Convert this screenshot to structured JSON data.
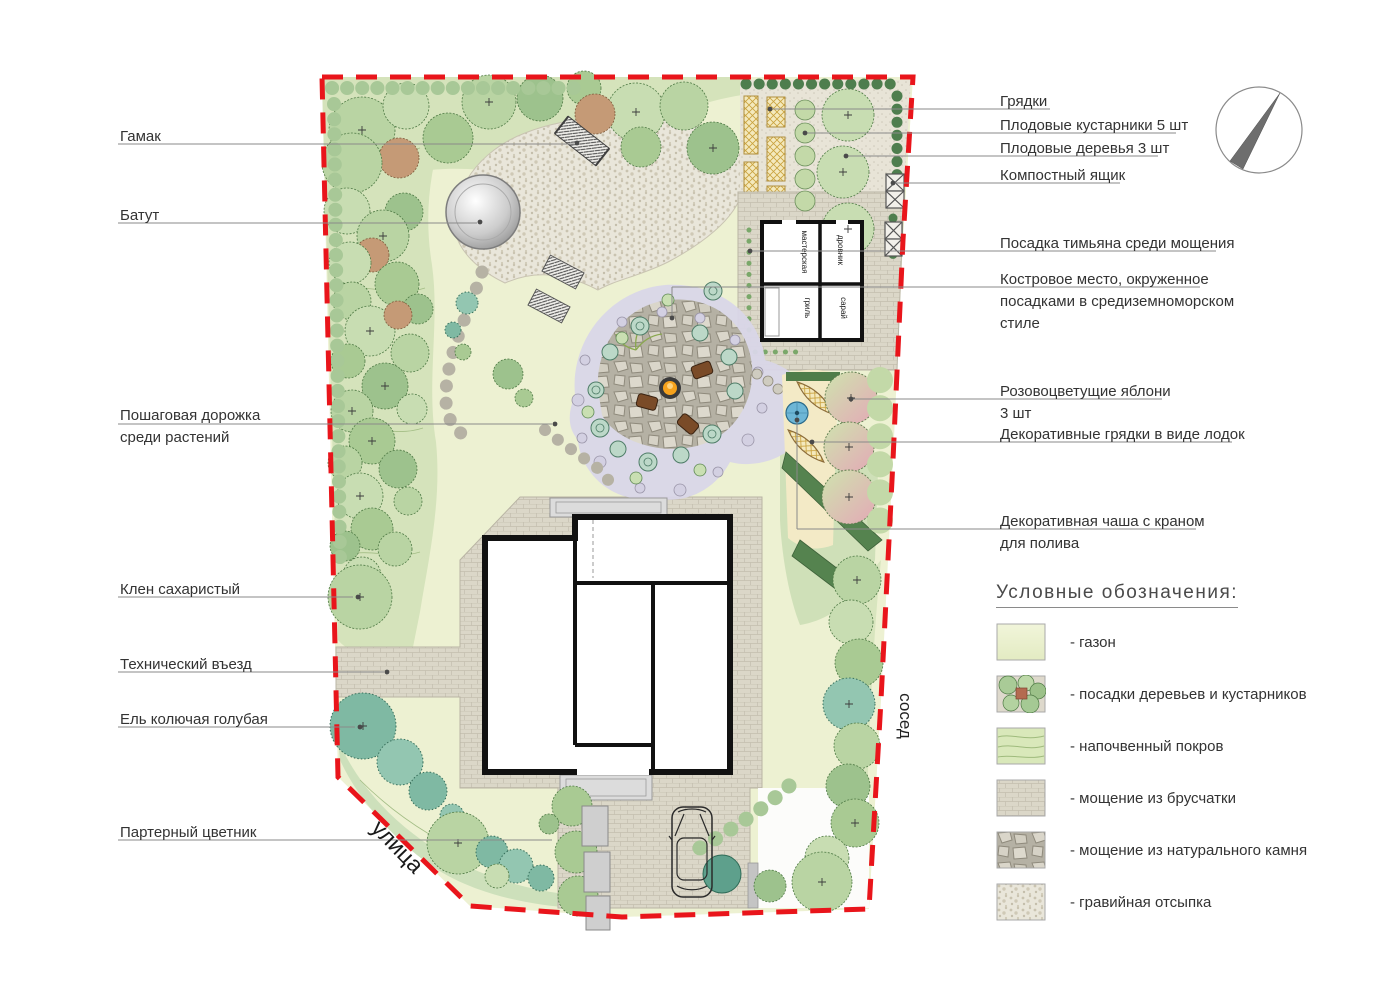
{
  "colors": {
    "boundary_red": "#e9151b",
    "lawn": "#edf1d2",
    "tree_green": "#b9d4a3",
    "spruce_teal": "#7fb9a3",
    "paving_brick": "#dbd7c8",
    "natural_stone": "#cbc7ba",
    "gravel": "#e9e6da",
    "fire_orange": "#f6a21c",
    "water_blue": "#6db6d6"
  },
  "left_labels": {
    "hammock": "Гамак",
    "trampoline": "Батут",
    "stepping_path_1": "Пошаговая дорожка",
    "stepping_path_2": "среди растений",
    "maple": "Клен сахаристый",
    "tech_entrance": "Технический въезд",
    "spruce": "Ель колючая голубая",
    "parterre": "Партерный цветник"
  },
  "right_labels": {
    "beds": "Грядки",
    "fruit_shrubs": "Плодовые кустарники 5 шт",
    "fruit_trees": "Плодовые деревья 3 шт",
    "compost": "Компостный ящик",
    "thyme": "Посадка тимьяна среди мощения",
    "firepit_1": "Костровое место, окруженное",
    "firepit_2": "посадками в средиземноморском",
    "firepit_3": "стиле",
    "apples_1": "Розовоцветущие яблони",
    "apples_2": "3 шт",
    "boat_beds": "Декоративные грядки в виде лодок",
    "bowl_1": "Декоративная чаша с краном",
    "bowl_2": "для полива"
  },
  "plan_texts": {
    "street": "улица",
    "neighbor": "сосед",
    "rooms": {
      "workshop": "мастерская",
      "woodshed": "дровник",
      "grill": "гриль",
      "shed": "сарай"
    }
  },
  "legend": {
    "title": "Условные обозначения:",
    "items": [
      {
        "label": "- газон"
      },
      {
        "label": "- посадки деревьев и кустарников"
      },
      {
        "label": "- напочвенный покров"
      },
      {
        "label": "- мощение из брусчатки"
      },
      {
        "label": "- мощение из натурального камня"
      },
      {
        "label": "- гравийная отсыпка"
      }
    ]
  }
}
